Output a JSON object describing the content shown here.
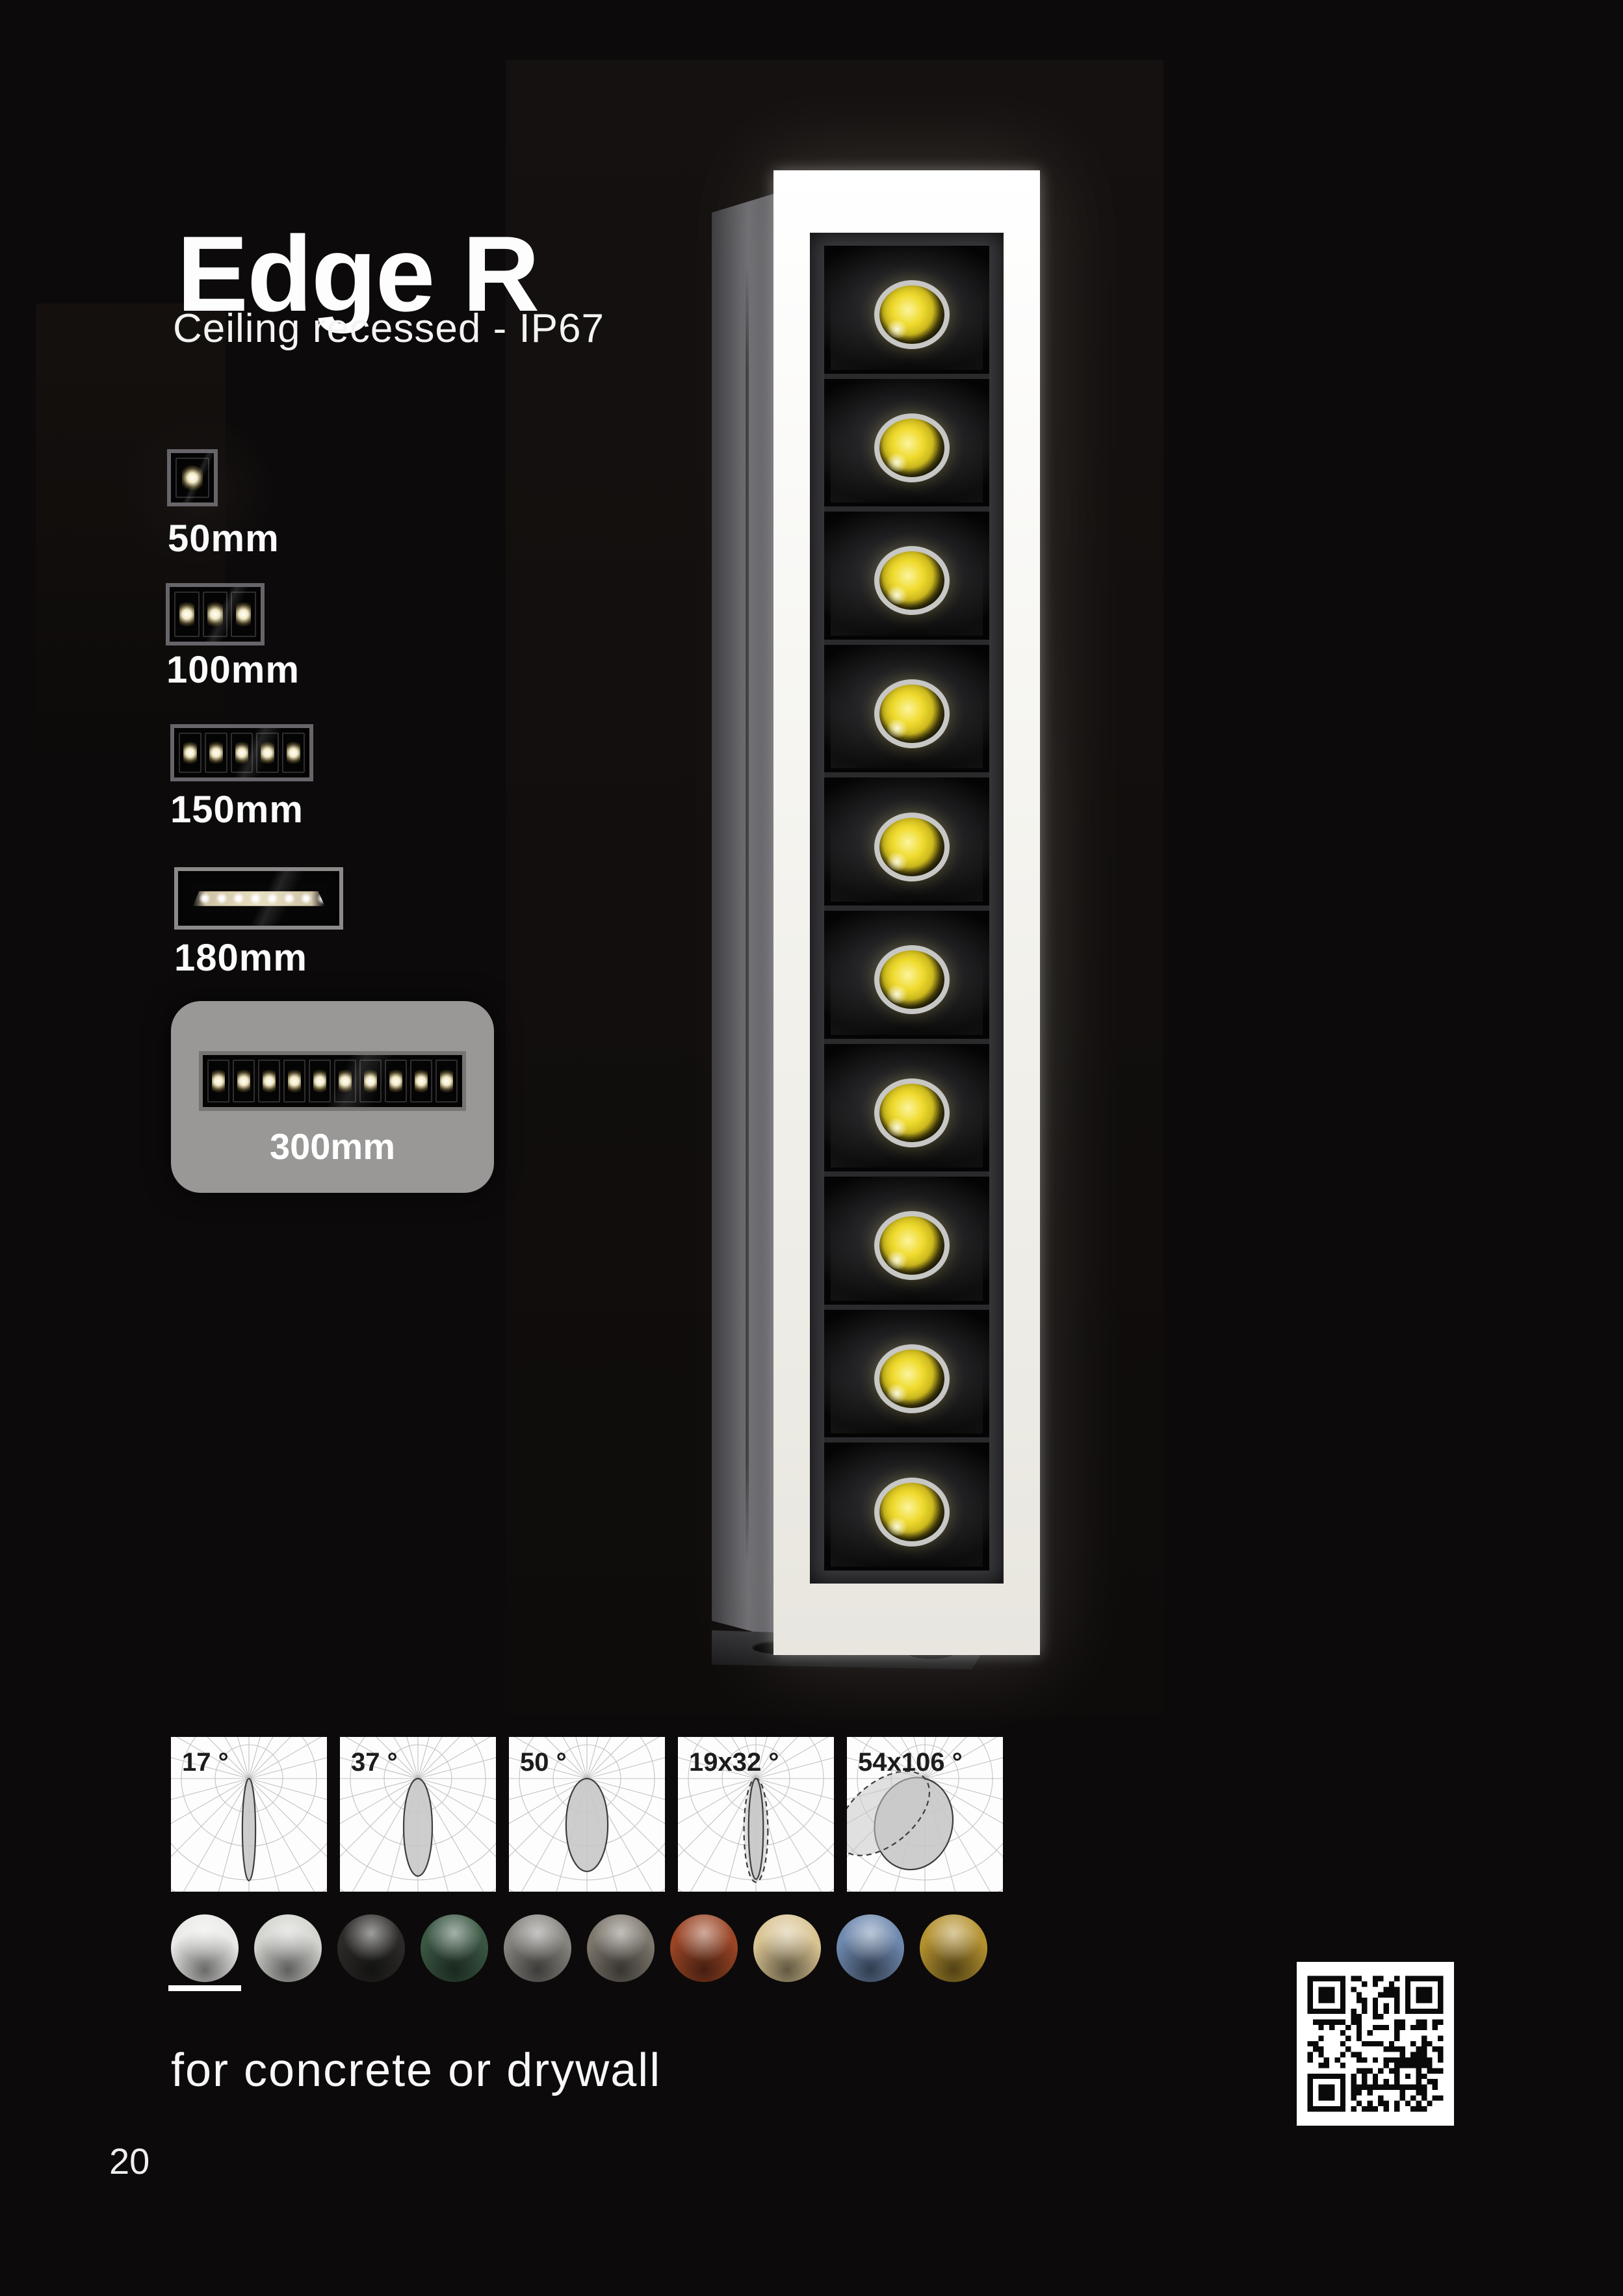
{
  "page": {
    "background": "#0c0a0a",
    "title": "Edge R",
    "subtitle": "Ceiling recessed - IP67",
    "footnote": "for concrete or drywall",
    "page_number": "20"
  },
  "size_options": {
    "selected": "300mm",
    "highlight_color": "#999897",
    "items": [
      {
        "label": "50mm",
        "leds": 1,
        "highlighted": false
      },
      {
        "label": "100mm",
        "leds": 3,
        "highlighted": false
      },
      {
        "label": "150mm",
        "leds": 5,
        "highlighted": false
      },
      {
        "label": "180mm",
        "leds": 9,
        "variant": "wallwash",
        "highlighted": false
      },
      {
        "label": "300mm",
        "leds": 10,
        "highlighted": true
      }
    ]
  },
  "hero": {
    "description": "Edge R linear recessed luminaire with illuminated white trim and 10 LED optics",
    "led_count": 10,
    "led_color": "#ecd829",
    "trim_color": "#f4f3ee",
    "housing_color": "#636267"
  },
  "chart_data": [
    {
      "type": "polar-beam",
      "label": "17 °",
      "beam_angles_deg": [
        17
      ],
      "lobes": [
        {
          "length": 0.66,
          "width": 0.085,
          "rotation": 0,
          "dashed": false
        }
      ]
    },
    {
      "type": "polar-beam",
      "label": "37 °",
      "beam_angles_deg": [
        37
      ],
      "lobes": [
        {
          "length": 0.63,
          "width": 0.185,
          "rotation": 0,
          "dashed": false
        }
      ]
    },
    {
      "type": "polar-beam",
      "label": "50 °",
      "beam_angles_deg": [
        50
      ],
      "lobes": [
        {
          "length": 0.6,
          "width": 0.27,
          "rotation": 0,
          "dashed": false
        }
      ]
    },
    {
      "type": "polar-beam",
      "label": "19x32 °",
      "beam_angles_deg": [
        19,
        32
      ],
      "lobes": [
        {
          "length": 0.67,
          "width": 0.155,
          "rotation": 0,
          "dashed": true
        },
        {
          "length": 0.65,
          "width": 0.095,
          "rotation": 0,
          "dashed": false
        }
      ]
    },
    {
      "type": "polar-beam",
      "label": "54x106 °",
      "beam_angles_deg": [
        54,
        106
      ],
      "lobes": [
        {
          "length": 0.6,
          "width": 0.5,
          "rotation": 14,
          "dashed": false
        },
        {
          "length": 0.7,
          "width": 0.4,
          "rotation": 50,
          "dashed": true
        }
      ]
    }
  ],
  "finishes": {
    "selected_index": 0,
    "swatches": [
      {
        "name": "white",
        "color": "#e9e9e7"
      },
      {
        "name": "light-grey",
        "color": "#d2d2ce"
      },
      {
        "name": "black",
        "color": "#2b2a28"
      },
      {
        "name": "forest-green",
        "color": "#3a5743"
      },
      {
        "name": "grey",
        "color": "#87847f"
      },
      {
        "name": "taupe-grey",
        "color": "#7c766c"
      },
      {
        "name": "corten-red",
        "color": "#9a4525"
      },
      {
        "name": "champagne",
        "color": "#d8c392"
      },
      {
        "name": "steel-blue",
        "color": "#6e88ae"
      },
      {
        "name": "brass",
        "color": "#b3912f"
      }
    ]
  },
  "qr": {
    "name": "qr-code"
  }
}
